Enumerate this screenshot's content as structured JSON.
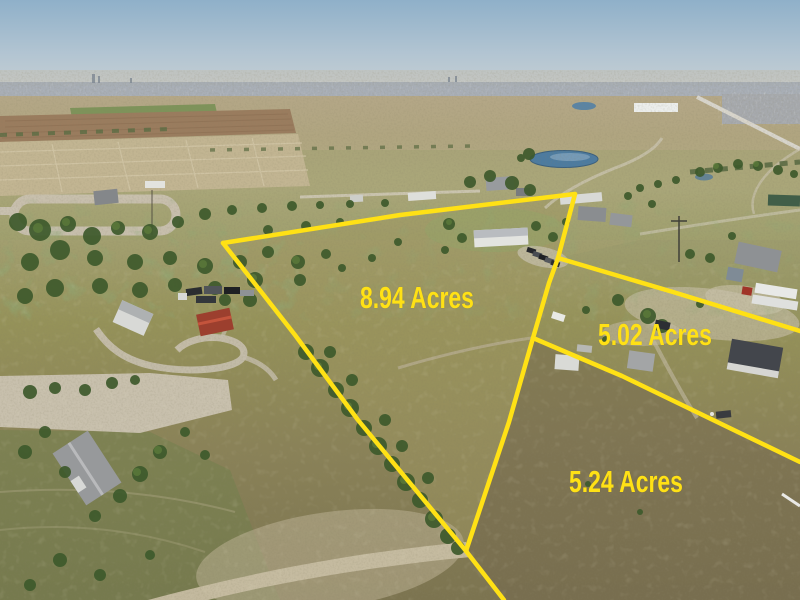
{
  "photo": {
    "kind": "aerial drone photograph",
    "scene": "rural acreage with surveyed parcel boundary overlay"
  },
  "annotations": {
    "accent_color": "#ffe115",
    "parcels": [
      {
        "id": "parcel-894",
        "label": "8.94 Acres"
      },
      {
        "id": "parcel-502",
        "label": "5.02 Acres"
      },
      {
        "id": "parcel-524",
        "label": "5.24 Acres"
      }
    ]
  }
}
